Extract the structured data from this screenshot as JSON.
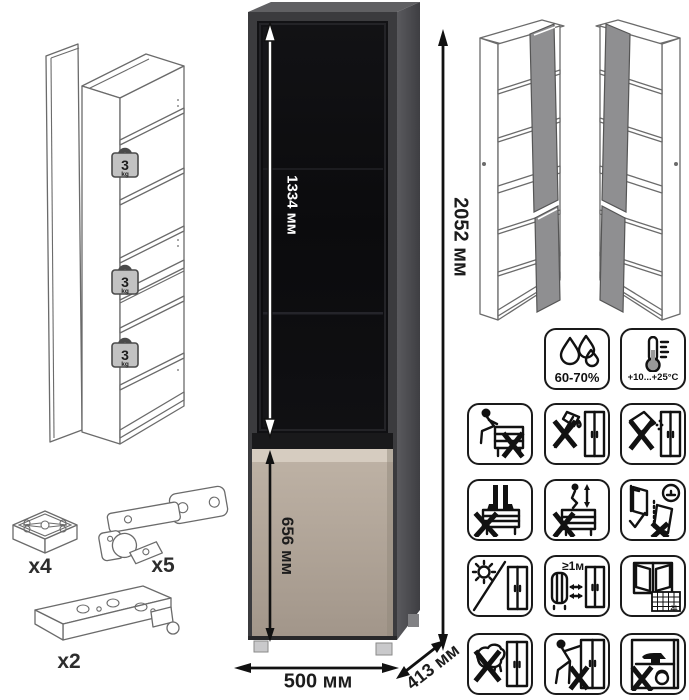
{
  "title": "Tall display cabinet assembly diagram",
  "dimensions": {
    "glass_door_height": "1334 мм",
    "total_height": "2052 мм",
    "lower_door_height": "656 мм",
    "width": "500 мм",
    "depth": "413 мм"
  },
  "shelf_load": {
    "value": "3",
    "unit": "kg"
  },
  "hardware": {
    "foot_count": "x4",
    "hinge_count": "x5",
    "rail_count": "x2"
  },
  "care": {
    "humidity": "60-70%",
    "temperature": "+10...+25°C",
    "min_heat_distance": "≥1м",
    "calendar_day": "21"
  },
  "colors": {
    "carcass_front": "#3b3b3e",
    "carcass_side": "#4f4f54",
    "carcass_top": "#606063",
    "glass": "#0d0d0f",
    "door_beige": "#b3a79a",
    "door_highlight": "#d6ccc0",
    "wireframe_door_gray": "#8f8f91",
    "badge_gray": "#c2c2c2"
  }
}
